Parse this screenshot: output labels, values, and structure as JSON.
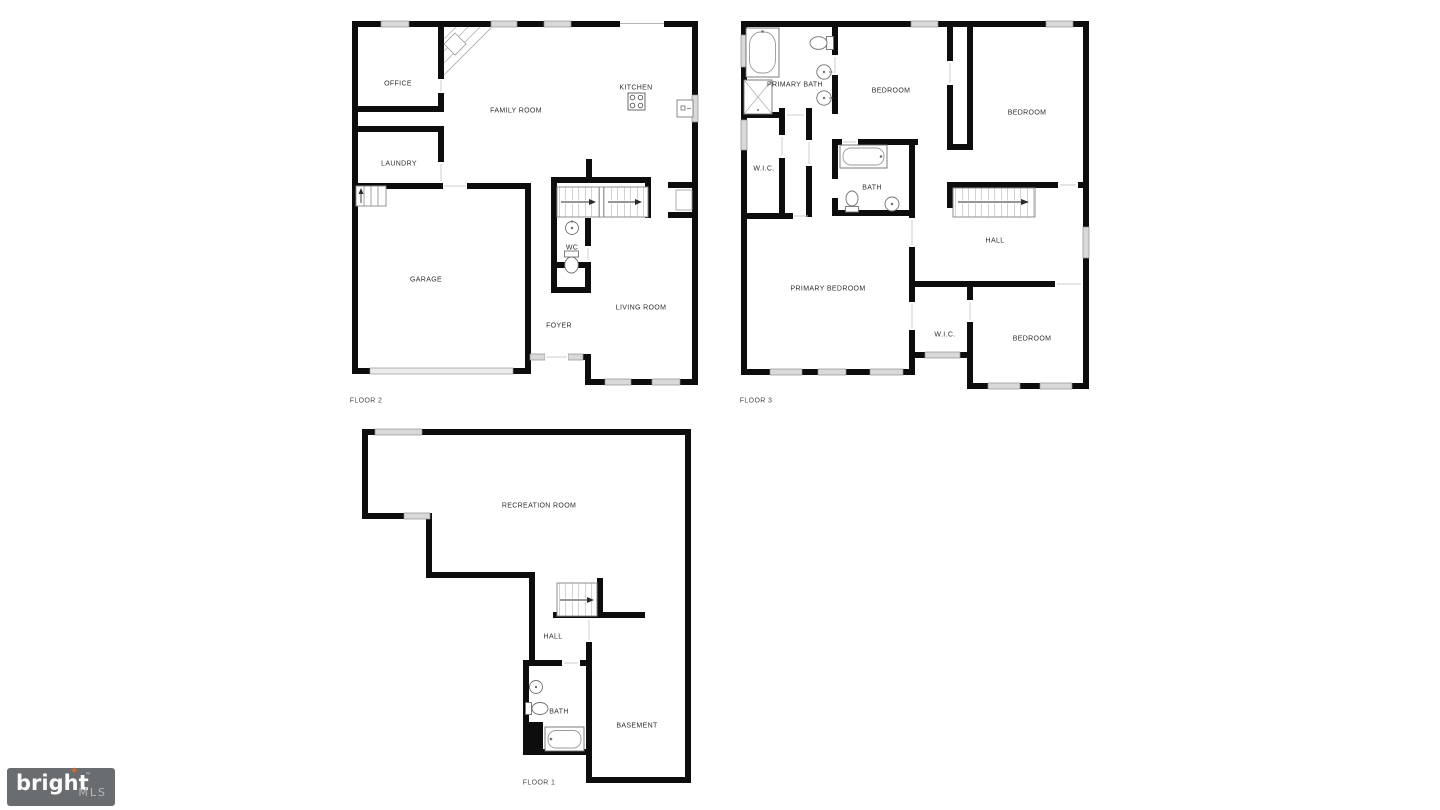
{
  "colors": {
    "wall": "#0d0d0d",
    "background": "#ffffff",
    "logo_box": "#6a6d6f",
    "logo_star": "#e4662b",
    "logo_text": "#fafafa",
    "logo_suffix": "#b4b7b9"
  },
  "floors": {
    "floor2": {
      "label": "FLOOR 2",
      "rooms": {
        "office": "OFFICE",
        "family_room": "FAMILY ROOM",
        "kitchen": "KITCHEN",
        "laundry": "LAUNDRY",
        "garage": "GARAGE",
        "wc": "WC",
        "living_room": "LIVING ROOM",
        "foyer": "FOYER"
      }
    },
    "floor3": {
      "label": "FLOOR 3",
      "rooms": {
        "primary_bath": "PRIMARY BATH",
        "bedroom_a": "BEDROOM",
        "bedroom_b": "BEDROOM",
        "wic_upper": "W.I.C.",
        "bath": "BATH",
        "hall": "HALL",
        "primary_bedroom": "PRIMARY BEDROOM",
        "wic_lower": "W.I.C.",
        "bedroom_c": "BEDROOM"
      }
    },
    "floor1": {
      "label": "FLOOR 1",
      "rooms": {
        "recreation_room": "RECREATION ROOM",
        "hall": "HALL",
        "bath": "BATH",
        "basement": "BASEMENT"
      }
    }
  },
  "logo": {
    "brand": "bright",
    "star_glyph": "✦",
    "trademark": "™",
    "suffix": "MLS"
  }
}
